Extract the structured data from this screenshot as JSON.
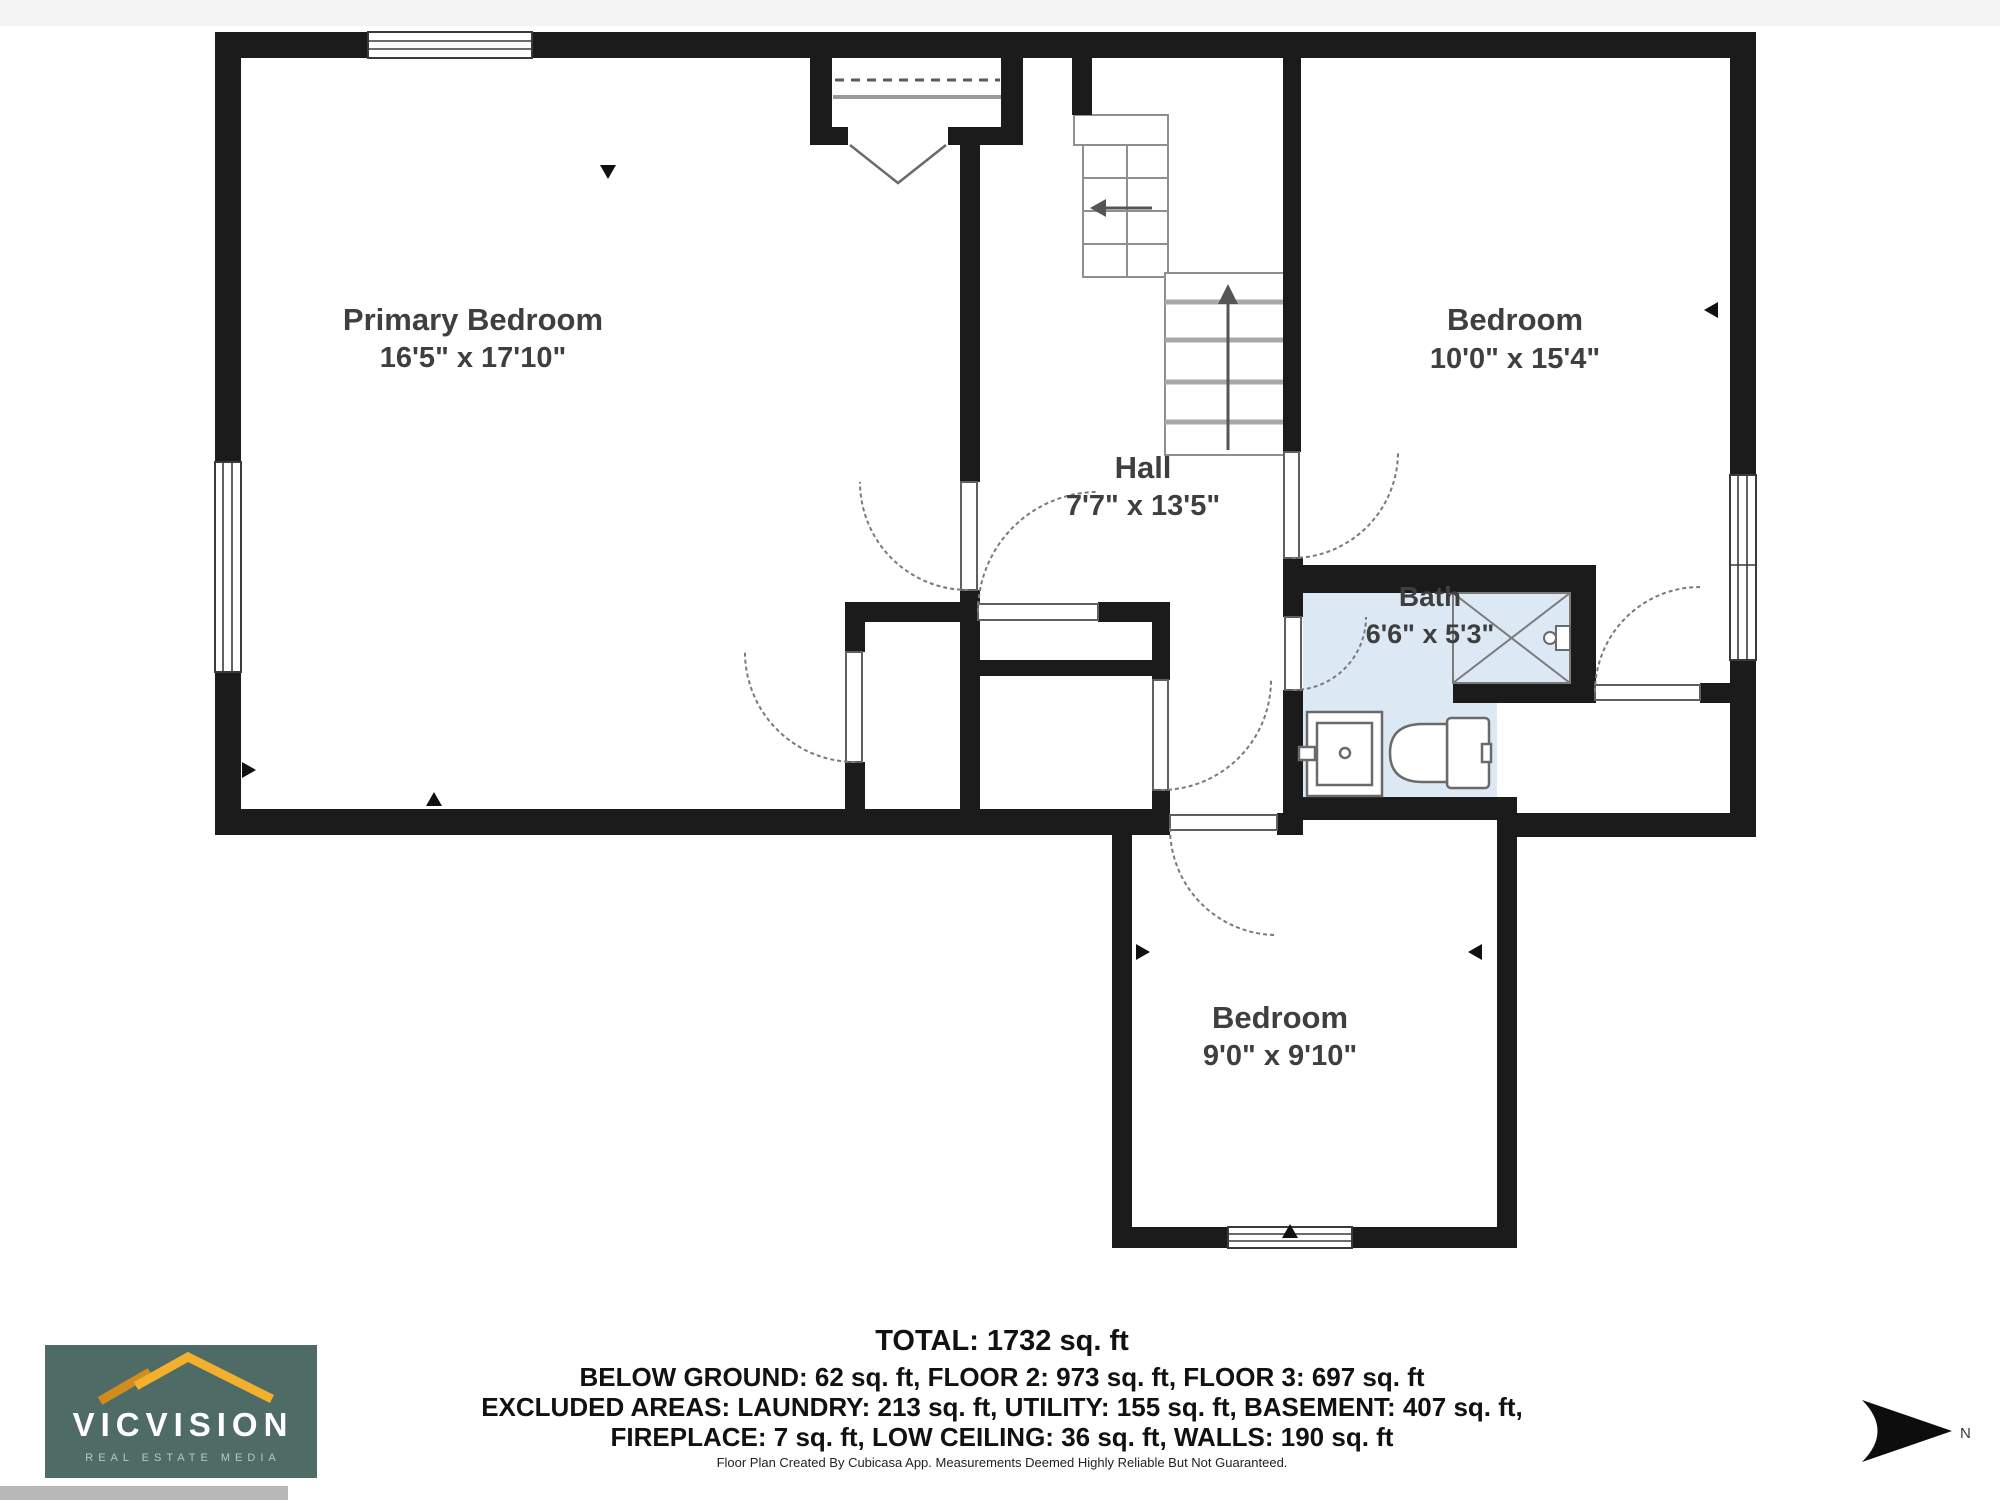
{
  "plan": {
    "rooms": [
      {
        "name": "Primary Bedroom",
        "dims": "16'5\" x 17'10\""
      },
      {
        "name": "Hall",
        "dims": "7'7\" x 13'5\""
      },
      {
        "name": "Bedroom",
        "dims": "10'0\" x 15'4\""
      },
      {
        "name": "Bath",
        "dims": "6'6\" x 5'3\""
      },
      {
        "name": "Bedroom",
        "dims": "9'0\" x 9'10\""
      }
    ]
  },
  "footer": {
    "total": "TOTAL: 1732 sq. ft",
    "line1": "BELOW GROUND: 62 sq. ft, FLOOR 2: 973 sq. ft, FLOOR 3: 697 sq. ft",
    "line2": "EXCLUDED AREAS: LAUNDRY: 213 sq. ft, UTILITY: 155 sq. ft, BASEMENT: 407 sq. ft,",
    "line3": "FIREPLACE: 7 sq. ft, LOW CEILING: 36 sq. ft, WALLS: 190 sq. ft",
    "disclaimer": "Floor Plan Created By Cubicasa App. Measurements Deemed Highly Reliable But Not Guaranteed."
  },
  "logo": {
    "name": "VICVISION",
    "tagline": "REAL ESTATE MEDIA",
    "bg_color": "#4e6b66",
    "roof_color": "#f2b02c",
    "roof_color_dark": "#d08c1f"
  },
  "compass": {
    "label": "N"
  },
  "colors": {
    "wall": "#1b1b1b",
    "bath_fill": "#dce9f5",
    "stair_line": "#8f8f8f",
    "arrow": "#0d0d0d"
  }
}
